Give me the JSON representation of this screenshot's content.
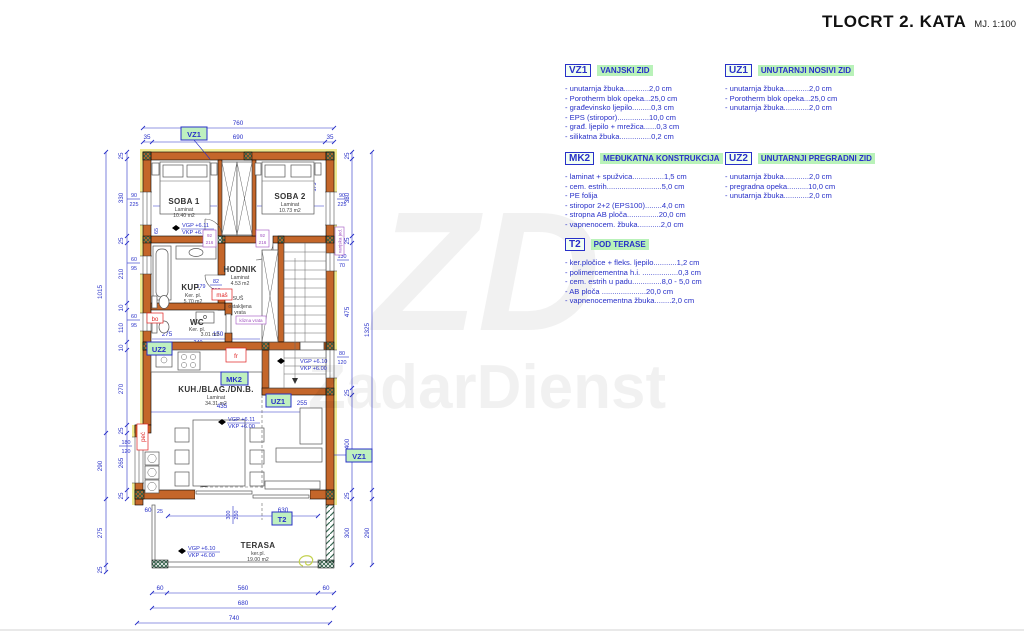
{
  "title": {
    "main": "TLOCRT 2. KATA",
    "scale": "MJ. 1:100"
  },
  "legend": {
    "vz1": {
      "tag": "VZ1",
      "title": "VANJSKI ZID",
      "items": [
        "- unutarnja žbuka............2,0 cm",
        "- Porotherm blok opeka...25,0 cm",
        "- građevinsko ljepilo.........0,3 cm",
        "- EPS (stiropor)...............10,0 cm",
        "- građ. ljepilo + mrežica......0,3 cm",
        "- silikatna žbuka...............0,2 cm"
      ]
    },
    "uz1": {
      "tag": "UZ1",
      "title": "UNUTARNJI NOSIVI ZID",
      "items": [
        "- unutarnja žbuka............2,0 cm",
        "- Porotherm blok opeka...25,0 cm",
        "- unutarnja žbuka............2,0 cm"
      ]
    },
    "mk2": {
      "tag": "MK2",
      "title": "MEĐUKATNA KONSTRUKCIJA",
      "items": [
        "- laminat + spužvica...............1,5 cm",
        "- cem. estrih..........................5,0 cm",
        "- PE folija",
        "- stiropor 2+2 (EPS100)........4,0 cm",
        "- stropna AB ploča...............20,0 cm",
        "- vapnenocem. žbuka...........2,0 cm"
      ]
    },
    "uz2": {
      "tag": "UZ2",
      "title": "UNUTARNJI PREGRADNI ZID",
      "items": [
        "- unutarnja žbuka............2,0 cm",
        "- pregradna opeka..........10,0 cm",
        "- unutarnja žbuka............2,0 cm"
      ]
    },
    "t2": {
      "tag": "T2",
      "title": "POD TERASE",
      "items": [
        "- ker.pločice + fleks. ljepilo...........1,2 cm",
        "- polimercementna h.i. .................0,3 cm",
        "- cem. estrih u padu..............8,0 - 5,0 cm",
        "- AB ploča .....................20,0 cm",
        "- vapnenocementna žbuka........2,0 cm"
      ]
    }
  },
  "watermark": {
    "text": "ZadarDienst",
    "monogram": "ZD"
  },
  "plan": {
    "tags": {
      "vz1": "VZ1",
      "uz1": "UZ1",
      "uz2": "UZ2",
      "mk2": "MK2",
      "t2": "T2"
    },
    "rooms": {
      "soba1": {
        "name": "SOBA 1",
        "floor": "Laminat",
        "area": "10.40 m2"
      },
      "soba2": {
        "name": "SOBA 2",
        "floor": "Laminat",
        "area": "10.73 m2"
      },
      "hodnik": {
        "name": "HODNIK",
        "floor": "Laminat",
        "area": "4.53 m2"
      },
      "kup": {
        "name": "KUP.",
        "floor": "Ker. pl.",
        "area": "5.70 m2"
      },
      "wc": {
        "name": "WC",
        "floor": "Ker. pl.",
        "area": "3.01 m2"
      },
      "kuh": {
        "name": "KUH./BLAG./DN.B.",
        "floor": "Laminat",
        "area": "34.31 m2"
      },
      "terasa": {
        "name": "TERASA",
        "floor": "ker.pl.",
        "area": "19.00 m2"
      }
    },
    "levels": {
      "vgp611": "VGP +6.11",
      "vgp610": "VGP +6.10",
      "vkp600": "VKP +6.00"
    },
    "labels": {
      "mas": "maš",
      "bo": "bo",
      "fr": "fr",
      "pec": "peć",
      "sus": "SUŠ",
      "ostakljena1": "ostakljena",
      "ostakljena2": "vrata",
      "vanjska": "vanjska jed.",
      "klizna": "klizna vrata"
    },
    "doors": {
      "w": "92",
      "h": "216"
    },
    "dims": {
      "d10": "10",
      "d25": "25",
      "d28": "28",
      "d35": "35",
      "d60": "60",
      "d65": "65",
      "d70": "70",
      "d80": "80",
      "d82": "82",
      "d90": "90",
      "d95": "95",
      "d100": "100",
      "d110": "110",
      "d120": "120",
      "d130": "130",
      "d135": "135",
      "d150": "150",
      "d175": "175",
      "d179": "179",
      "d180": "180",
      "d200": "200",
      "d210": "210",
      "d216": "216",
      "d220": "220",
      "d225": "225",
      "d230": "230",
      "d240": "240",
      "d250": "250",
      "d255": "255",
      "d265": "265",
      "d270": "270",
      "d275": "275",
      "d290": "290",
      "d300": "300",
      "d330": "330",
      "d335": "335",
      "d345": "345",
      "d400": "400",
      "d435": "435",
      "d475": "475",
      "d560": "560",
      "d630": "630",
      "d680": "680",
      "d690": "690",
      "d740": "740",
      "d760": "760",
      "d1015": "1015",
      "d1325": "1325"
    }
  }
}
